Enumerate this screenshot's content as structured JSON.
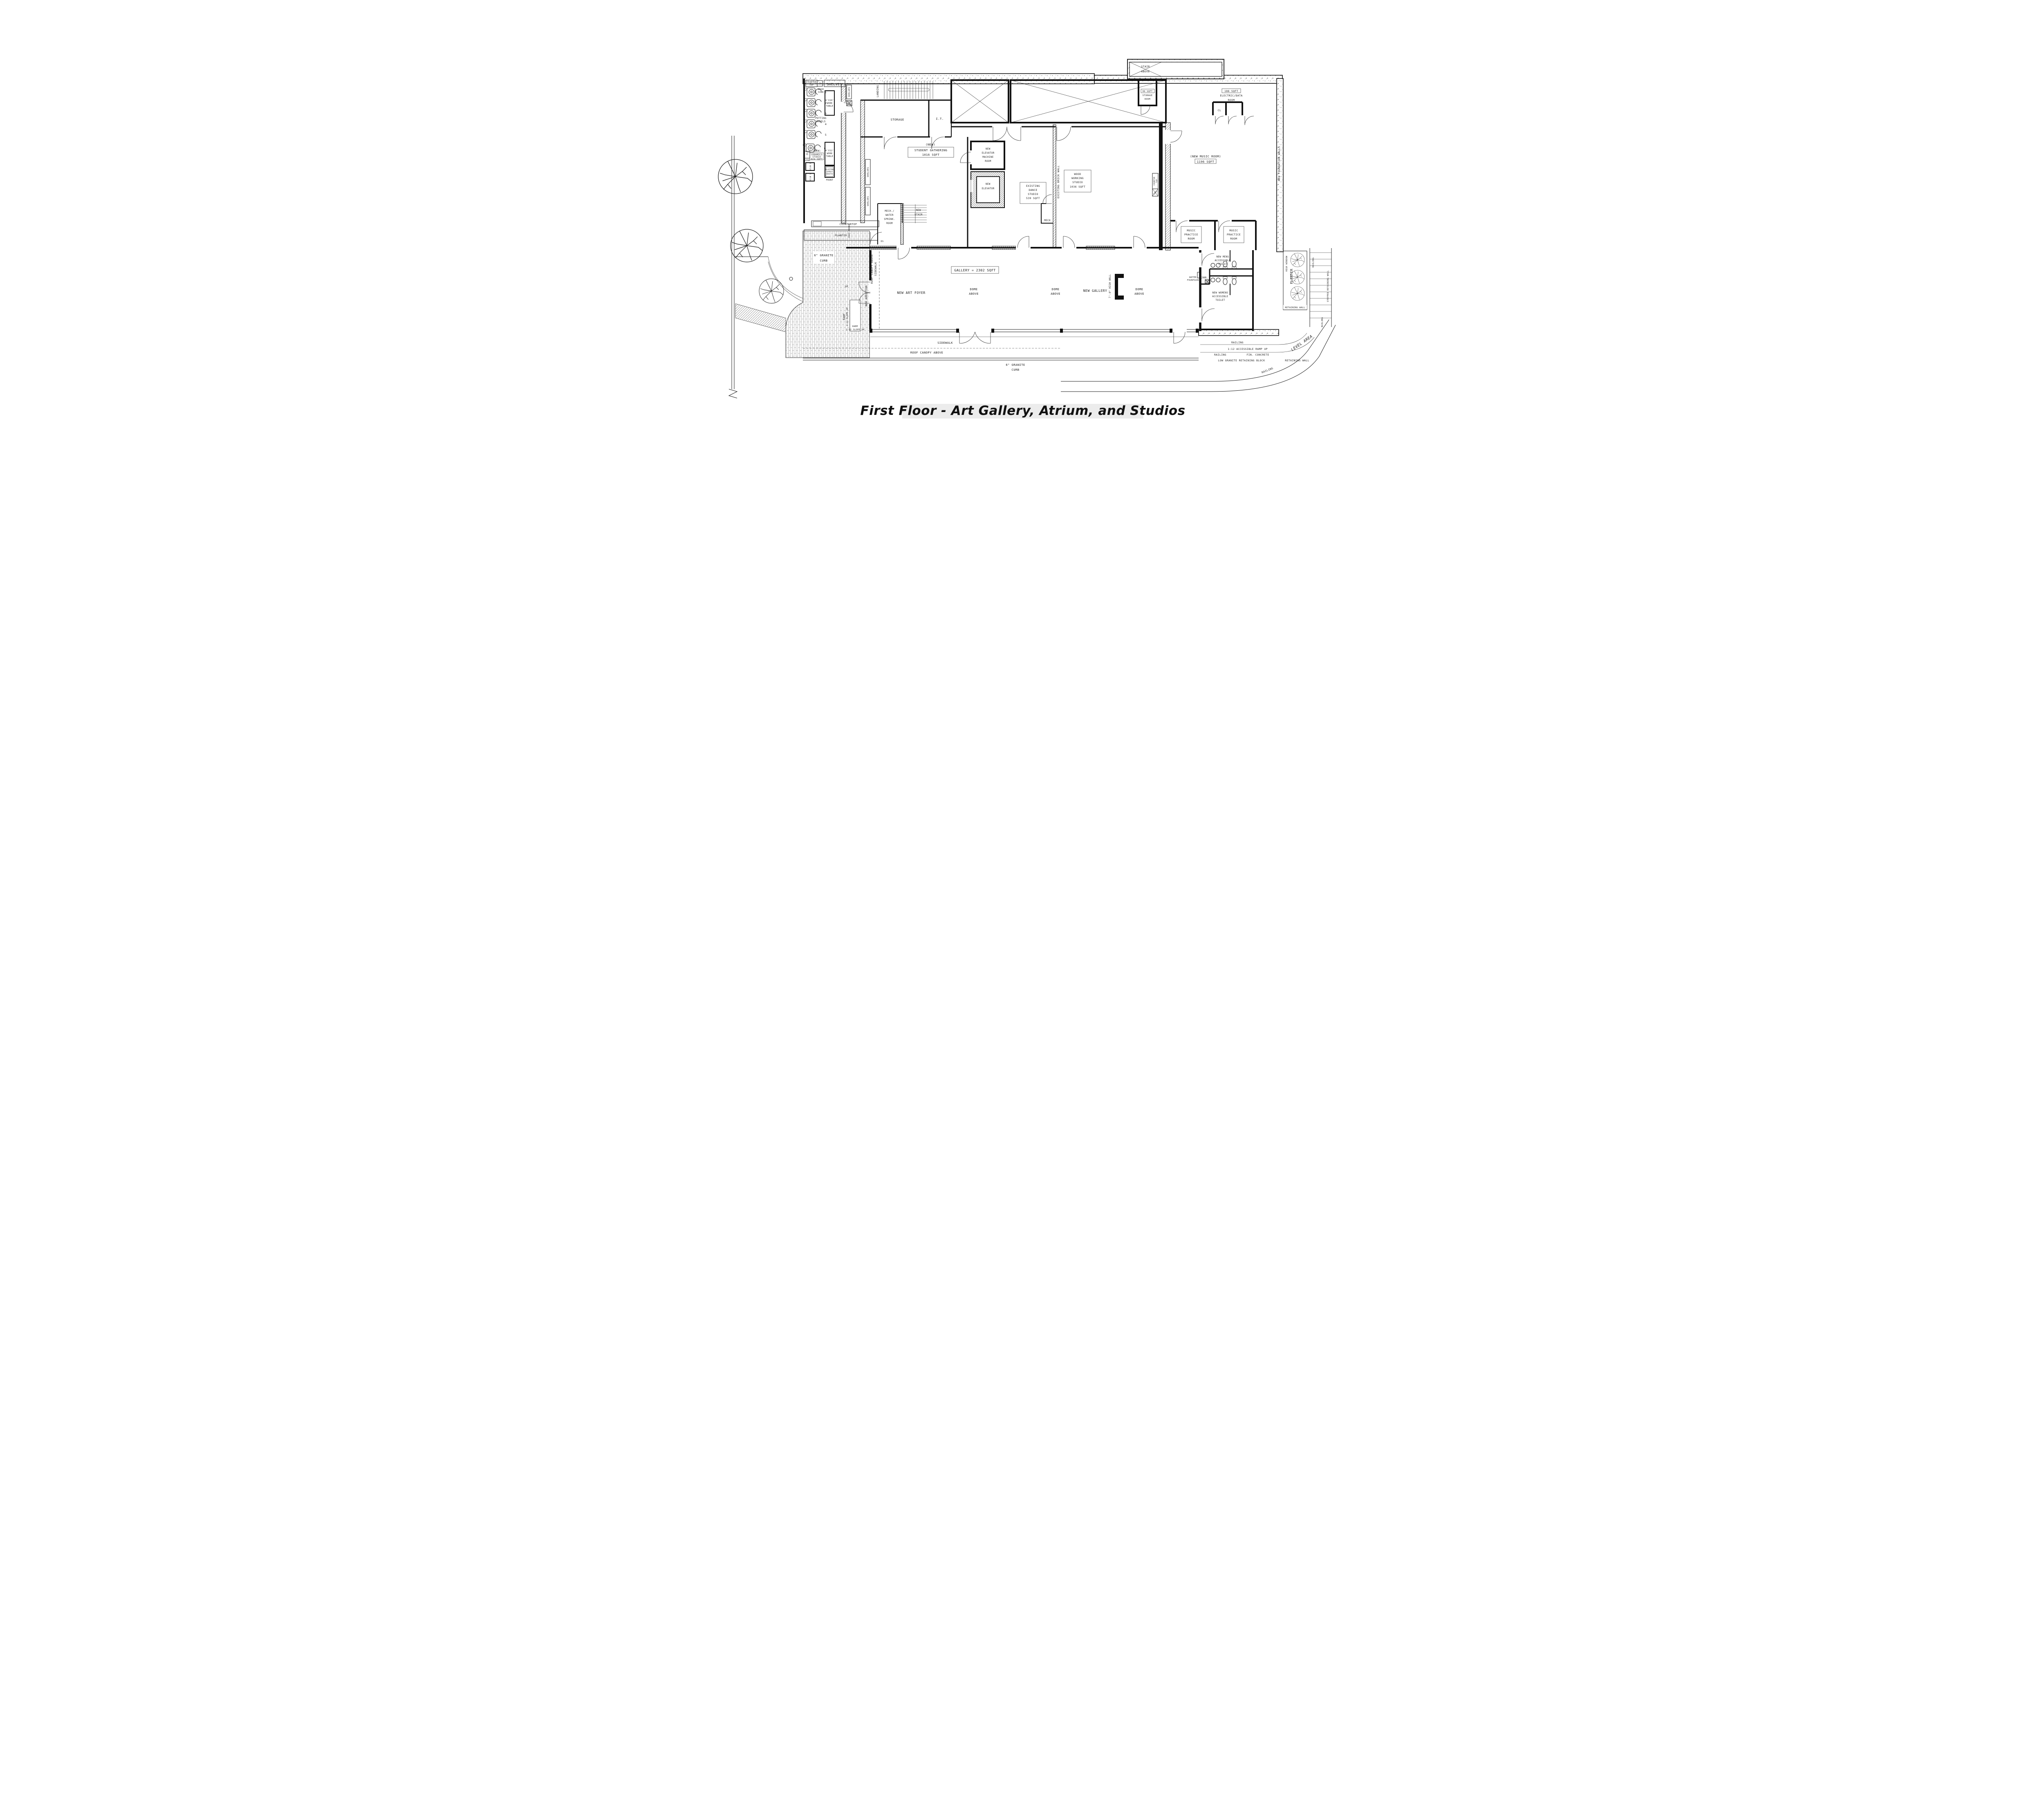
{
  "title": "First Floor - Art Gallery, Atrium, and Studios",
  "labels": {
    "counter_top": [
      "COUNTER",
      "TOP"
    ],
    "wash_sink": [
      "WASH",
      "SINK"
    ],
    "shelves": "SHELVES",
    "landing": "LANDING",
    "storage": "STORAGE",
    "it_room": "I.T.",
    "mop_sink": [
      "MOP",
      "SINK"
    ],
    "potting_wheels": [
      "POTTING",
      "WHEELS"
    ],
    "wheel_numbers": [
      "1",
      "2",
      "3",
      "4",
      "5",
      "6"
    ],
    "work_table_410": [
      "4'X10'",
      "WORK",
      "TABLE"
    ],
    "work_table_412": [
      "4'X12'",
      "WORK",
      "TABLE"
    ],
    "new_tag": "(NEW)",
    "ceramics_studio": [
      "CERAMICS",
      "STUDIO",
      "824 SQFT"
    ],
    "sink": "SINK",
    "kiln_1": "KILN 1",
    "kiln_2": "KILN 2",
    "glazing_booth": [
      "GLAZING",
      "SPRAY",
      "BOOTH"
    ],
    "front": "FRONT",
    "coat_hooks": "COAT HOOKS",
    "countertop": "COUNTERTOP",
    "planter": "PLANTER",
    "ds": "DS",
    "up": "UP",
    "student_gathering": [
      "STUDENT GATHERING",
      "1016 SQFT"
    ],
    "elevator_machine_room": [
      "NEW",
      "ELEVATOR",
      "MACHINE",
      "ROOM"
    ],
    "new_elevator": [
      "NEW",
      "ELEVATOR"
    ],
    "dance_studio": [
      "EXISTING",
      "DANCE",
      "STUDIO",
      "539 SQFT"
    ],
    "existing_brick_wall": "EXISTING BRICK WALL",
    "wood_working": [
      "WOOD",
      "WORKING",
      "STUDIO",
      "1036 SQFT"
    ],
    "mech": "MECH",
    "mech_water": [
      "MECH./",
      "WATER",
      "SPRINK.",
      "ROOM"
    ],
    "new_stair": [
      "NEW",
      "STAIR"
    ],
    "stair_above": [
      "STAIR",
      "ABOVE"
    ],
    "new_foundation_walls": "NEW FOUNDATION WALLS",
    "storage_99": [
      "99 SQFT",
      "STORAGE",
      "ROOM"
    ],
    "electric_data": [
      "186 SQFT",
      "ELECTRIC/DATA",
      "ROOM"
    ],
    "cl": "CL",
    "music_room": "(NEW MUSIC ROOM)",
    "music_room_sqft": "1196 SQFT",
    "music_practice": [
      "MUSIC",
      "PRACTICE",
      "ROOM"
    ],
    "gallery_sqft": "GALLERY = 2302 SQFT",
    "new_art_foyer": "NEW ART FOYER",
    "dome_above": [
      "DOME",
      "ABOVE"
    ],
    "new_gallery": "NEW GALLERY",
    "high_wall": "7'-0\" HIGH WALL",
    "mens_toilet": [
      "NEW MENS",
      "ACCESSIBLE",
      "TOILET"
    ],
    "jan": "JAN.",
    "water_fountain": [
      "WATER",
      "FOUNTAIN"
    ],
    "womens_toilet": [
      "NEW WOMENS",
      "ACCESSIBLE",
      "TOILET"
    ],
    "granite_curb": [
      "6\" GRANITE",
      "CURB"
    ],
    "roof_canopy_above": "ROOF CANOPY ABOVE",
    "roof_canopy_sidewalk": [
      "ROOF CANOPY ABOVE",
      "SIDEWALK"
    ],
    "new_addition": "NEW ADDITION",
    "ramp_slope": [
      "RAMP",
      "1:12 SLOPE UP"
    ],
    "sidewalk": "SIDEWALK",
    "high_window": "HIGH WINDOW",
    "retaining_wall": "RETAINING WALL",
    "railing": "RAILING",
    "stepped_retaining_wall": "STEPPED RETAINING WALL",
    "level_area": "LEVEL AREA",
    "accessible_ramp": "1:12 ACCESSIBLE RAMP UP",
    "fin_concrete": "FIN. CONCRETE",
    "low_granite": "LOW GRANITE RETAINING BLOCK"
  },
  "colors": {
    "ink": "#1b1b1b",
    "paper": "#ffffff"
  }
}
